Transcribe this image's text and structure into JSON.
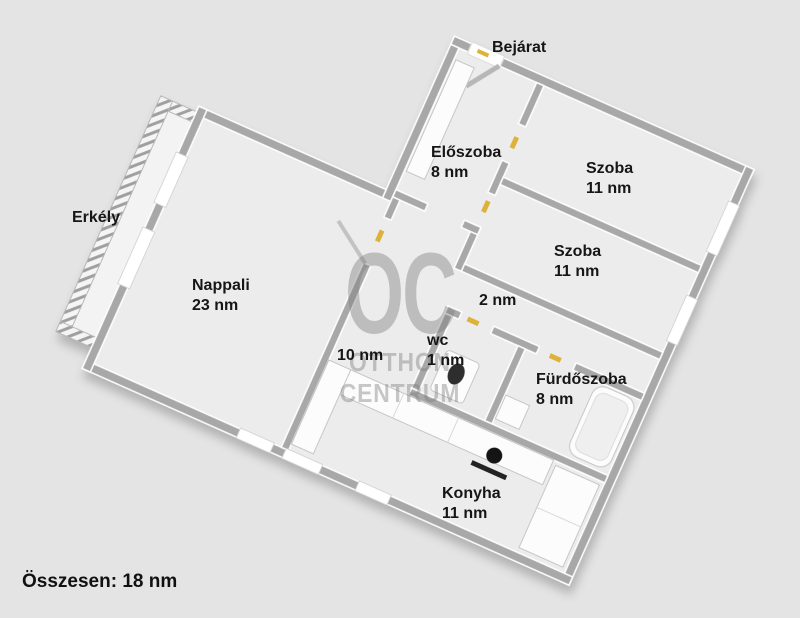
{
  "exterior_labels": {
    "entrance": "Bejárat",
    "balcony": "Erkély"
  },
  "rooms": {
    "nappali": {
      "name": "Nappali",
      "area": "23 nm"
    },
    "eloszoba": {
      "name": "Előszoba",
      "area": "8 nm"
    },
    "szoba_felso": {
      "name": "Szoba",
      "area": "11 nm"
    },
    "szoba_also": {
      "name": "Szoba",
      "area": "11 nm"
    },
    "kozlekedo_kis": {
      "name": "",
      "area": "2 nm"
    },
    "kozlekedo_nagy": {
      "name": "",
      "area": "10 nm"
    },
    "wc": {
      "name": "wc",
      "area": "1 nm"
    },
    "furdoszoba": {
      "name": "Fürdőszoba",
      "area": "8 nm"
    },
    "konyha": {
      "name": "Konyha",
      "area": "11 nm"
    }
  },
  "summary": {
    "total_label": "Összesen: 18 nm"
  },
  "watermark": {
    "initials": "OC",
    "word1": "OTTHON",
    "word2": "CENTRUM"
  },
  "palette": {
    "background": "#e4e4e4",
    "floor": "#ececec",
    "wall": "#a8a8a8",
    "wall_cap": "#ffffff",
    "door_marker": "#ddb23a",
    "text": "#161616"
  },
  "fixtures": [
    "entrance-door",
    "wardrobe",
    "balcony-railing",
    "balcony-door",
    "window",
    "bathtub",
    "washbasin",
    "toilet",
    "kitchen-counter",
    "stove-hob",
    "kitchen-cabinet"
  ]
}
